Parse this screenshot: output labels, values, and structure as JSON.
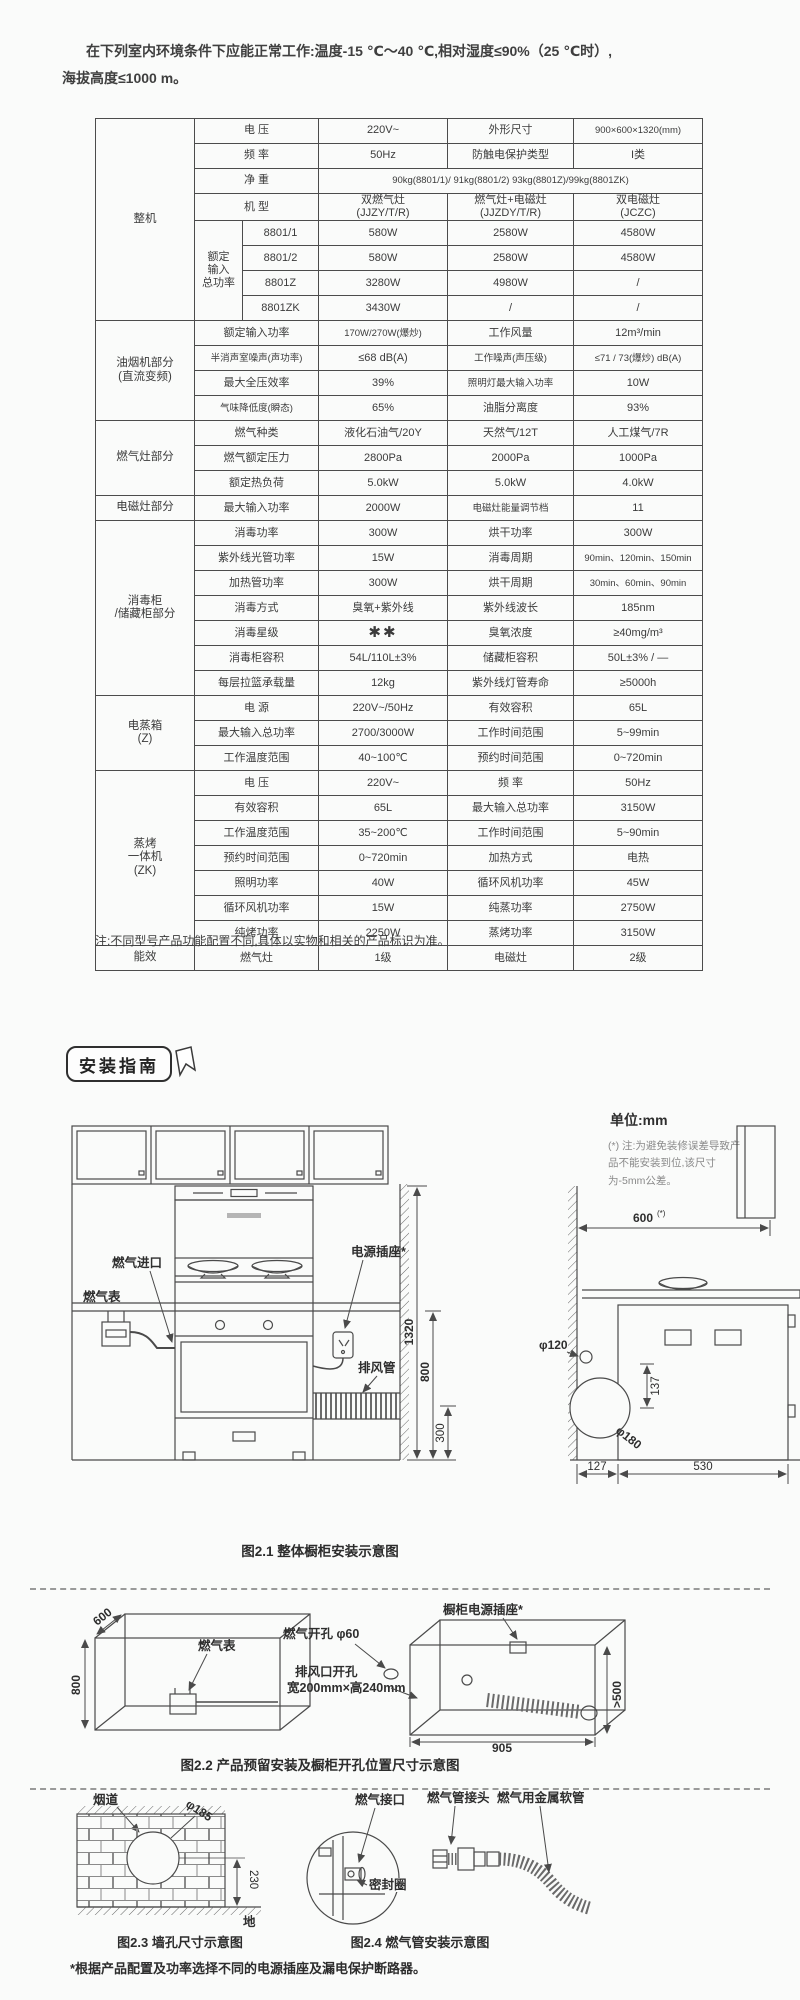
{
  "page": {
    "intro_line1": "在下列室内环境条件下应能正常工作:温度-15 ℃～40 ℃,相对湿度≤90%（25 ℃时）,",
    "intro_line2": "海拔高度≤1000 m。",
    "table_note": "注:不同型号产品功能配置不同,具体以实物和相关的产品标识为准。",
    "bottom_note": "*根据产品配置及功率选择不同的电源插座及漏电保护断路器。",
    "colors": {
      "line": "#4a4a4a",
      "text": "#3a3a3a",
      "note_gray": "#8a8a8a"
    }
  },
  "install": {
    "badge": "安装指南",
    "unit_label": "单位:mm",
    "tolerance_note": "(*) 注:为避免装修误差导致产品不能安装到位,该尺寸为-5mm公差。"
  },
  "spec_table": {
    "rows": [
      [
        {
          "t": "整机",
          "rs": 8,
          "c": "g"
        },
        {
          "t": "电  压",
          "cs": 2,
          "c": "l"
        },
        {
          "t": "220V~"
        },
        {
          "t": "外形尺寸",
          "c": "l"
        },
        {
          "t": "900×600×1320(mm)",
          "c": "xs"
        }
      ],
      [
        {
          "t": "频  率",
          "cs": 2,
          "c": "l"
        },
        {
          "t": "50Hz"
        },
        {
          "t": "防触电保护类型",
          "c": "l"
        },
        {
          "t": "I类"
        }
      ],
      [
        {
          "t": "净  重",
          "cs": 2,
          "c": "l"
        },
        {
          "t": "90kg(8801/1)/ 91kg(8801/2) 93kg(8801Z)/99kg(8801ZK)",
          "cs": 3,
          "c": "xs"
        }
      ],
      [
        {
          "t": "机  型",
          "cs": 2,
          "c": "l"
        },
        {
          "t": "双燃气灶\n(JJZY/T/R)"
        },
        {
          "t": "燃气灶+电磁灶\n(JJZDY/T/R)"
        },
        {
          "t": "双电磁灶\n(JCZC)"
        }
      ],
      [
        {
          "t": "额定\n输入\n总功率",
          "rs": 4,
          "c": "l"
        },
        {
          "t": "8801/1"
        },
        {
          "t": "580W"
        },
        {
          "t": "2580W"
        },
        {
          "t": "4580W"
        }
      ],
      [
        {
          "t": "8801/2"
        },
        {
          "t": "580W"
        },
        {
          "t": "2580W"
        },
        {
          "t": "4580W"
        }
      ],
      [
        {
          "t": "8801Z"
        },
        {
          "t": "3280W"
        },
        {
          "t": "4980W"
        },
        {
          "t": "/"
        }
      ],
      [
        {
          "t": "8801ZK"
        },
        {
          "t": "3430W"
        },
        {
          "t": "/"
        },
        {
          "t": "/"
        }
      ],
      [
        {
          "t": "油烟机部分\n(直流变频)",
          "rs": 4,
          "c": "g"
        },
        {
          "t": "额定输入功率",
          "cs": 2,
          "c": "l"
        },
        {
          "t": "170W/270W(爆炒)",
          "c": "xs"
        },
        {
          "t": "工作风量",
          "c": "l"
        },
        {
          "t": "12m³/min"
        }
      ],
      [
        {
          "t": "半消声室噪声(声功率)",
          "cs": 2,
          "c": "l xs"
        },
        {
          "t": "≤68 dB(A)"
        },
        {
          "t": "工作噪声(声压级)",
          "c": "l xs"
        },
        {
          "t": "≤71 / 73(爆炒) dB(A)",
          "c": "xs"
        }
      ],
      [
        {
          "t": "最大全压效率",
          "cs": 2,
          "c": "l"
        },
        {
          "t": "39%"
        },
        {
          "t": "照明灯最大输入功率",
          "c": "l xs"
        },
        {
          "t": "10W"
        }
      ],
      [
        {
          "t": "气味降低度(瞬态)",
          "cs": 2,
          "c": "l xs"
        },
        {
          "t": "65%"
        },
        {
          "t": "油脂分离度",
          "c": "l"
        },
        {
          "t": "93%"
        }
      ],
      [
        {
          "t": "燃气灶部分",
          "rs": 3,
          "c": "g"
        },
        {
          "t": "燃气种类",
          "cs": 2,
          "c": "l"
        },
        {
          "t": "液化石油气/20Y"
        },
        {
          "t": "天然气/12T"
        },
        {
          "t": "人工煤气/7R"
        }
      ],
      [
        {
          "t": "燃气额定压力",
          "cs": 2,
          "c": "l"
        },
        {
          "t": "2800Pa"
        },
        {
          "t": "2000Pa"
        },
        {
          "t": "1000Pa"
        }
      ],
      [
        {
          "t": "额定热负荷",
          "cs": 2,
          "c": "l"
        },
        {
          "t": "5.0kW"
        },
        {
          "t": "5.0kW"
        },
        {
          "t": "4.0kW"
        }
      ],
      [
        {
          "t": "电磁灶部分",
          "c": "g"
        },
        {
          "t": "最大输入功率",
          "cs": 2,
          "c": "l"
        },
        {
          "t": "2000W"
        },
        {
          "t": "电磁灶能量调节档",
          "c": "l xs"
        },
        {
          "t": "11"
        }
      ],
      [
        {
          "t": "消毒柜\n/储藏柜部分",
          "rs": 7,
          "c": "g"
        },
        {
          "t": "消毒功率",
          "cs": 2,
          "c": "l"
        },
        {
          "t": "300W"
        },
        {
          "t": "烘干功率",
          "c": "l"
        },
        {
          "t": "300W"
        }
      ],
      [
        {
          "t": "紫外线光管功率",
          "cs": 2,
          "c": "l"
        },
        {
          "t": "15W"
        },
        {
          "t": "消毒周期",
          "c": "l"
        },
        {
          "t": "90min、120min、150min",
          "c": "xs"
        }
      ],
      [
        {
          "t": "加热管功率",
          "cs": 2,
          "c": "l"
        },
        {
          "t": "300W"
        },
        {
          "t": "烘干周期",
          "c": "l"
        },
        {
          "t": "30min、60min、90min",
          "c": "xs"
        }
      ],
      [
        {
          "t": "消毒方式",
          "cs": 2,
          "c": "l"
        },
        {
          "t": "臭氧+紫外线"
        },
        {
          "t": "紫外线波长",
          "c": "l"
        },
        {
          "t": "185nm"
        }
      ],
      [
        {
          "t": "消毒星级",
          "cs": 2,
          "c": "l"
        },
        {
          "t": "✱✱",
          "c": "star"
        },
        {
          "t": "臭氧浓度",
          "c": "l"
        },
        {
          "t": "≥40mg/m³"
        }
      ],
      [
        {
          "t": "消毒柜容积",
          "cs": 2,
          "c": "l"
        },
        {
          "t": "54L/110L±3%"
        },
        {
          "t": "储藏柜容积",
          "c": "l"
        },
        {
          "t": "50L±3% / —"
        }
      ],
      [
        {
          "t": "每层拉篮承载量",
          "cs": 2,
          "c": "l"
        },
        {
          "t": "12kg"
        },
        {
          "t": "紫外线灯管寿命",
          "c": "l"
        },
        {
          "t": "≥5000h"
        }
      ],
      [
        {
          "t": "电蒸箱\n(Z)",
          "rs": 3,
          "c": "g"
        },
        {
          "t": "电  源",
          "cs": 2,
          "c": "l"
        },
        {
          "t": "220V~/50Hz"
        },
        {
          "t": "有效容积",
          "c": "l"
        },
        {
          "t": "65L"
        }
      ],
      [
        {
          "t": "最大输入总功率",
          "cs": 2,
          "c": "l"
        },
        {
          "t": "2700/3000W"
        },
        {
          "t": "工作时间范围",
          "c": "l"
        },
        {
          "t": "5~99min"
        }
      ],
      [
        {
          "t": "工作温度范围",
          "cs": 2,
          "c": "l"
        },
        {
          "t": "40~100℃"
        },
        {
          "t": "预约时间范围",
          "c": "l"
        },
        {
          "t": "0~720min"
        }
      ],
      [
        {
          "t": "蒸烤\n一体机\n(ZK)",
          "rs": 7,
          "c": "g"
        },
        {
          "t": "电  压",
          "cs": 2,
          "c": "l"
        },
        {
          "t": "220V~"
        },
        {
          "t": "频  率",
          "c": "l"
        },
        {
          "t": "50Hz"
        }
      ],
      [
        {
          "t": "有效容积",
          "cs": 2,
          "c": "l"
        },
        {
          "t": "65L"
        },
        {
          "t": "最大输入总功率",
          "c": "l"
        },
        {
          "t": "3150W"
        }
      ],
      [
        {
          "t": "工作温度范围",
          "cs": 2,
          "c": "l"
        },
        {
          "t": "35~200℃"
        },
        {
          "t": "工作时间范围",
          "c": "l"
        },
        {
          "t": "5~90min"
        }
      ],
      [
        {
          "t": "预约时间范围",
          "cs": 2,
          "c": "l"
        },
        {
          "t": "0~720min"
        },
        {
          "t": "加热方式",
          "c": "l"
        },
        {
          "t": "电热"
        }
      ],
      [
        {
          "t": "照明功率",
          "cs": 2,
          "c": "l"
        },
        {
          "t": "40W"
        },
        {
          "t": "循环风机功率",
          "c": "l"
        },
        {
          "t": "45W"
        }
      ],
      [
        {
          "t": "循环风机功率",
          "cs": 2,
          "c": "l"
        },
        {
          "t": "15W"
        },
        {
          "t": "纯蒸功率",
          "c": "l"
        },
        {
          "t": "2750W"
        }
      ],
      [
        {
          "t": "纯烤功率",
          "cs": 2,
          "c": "l"
        },
        {
          "t": "2250W"
        },
        {
          "t": "蒸烤功率",
          "c": "l"
        },
        {
          "t": "3150W"
        }
      ],
      [
        {
          "t": "能效",
          "c": "g"
        },
        {
          "t": "燃气灶",
          "cs": 2,
          "c": "l"
        },
        {
          "t": "1级"
        },
        {
          "t": "电磁灶",
          "c": "l"
        },
        {
          "t": "2级"
        }
      ]
    ]
  },
  "fig21": {
    "caption": "图2.1 整体橱柜安装示意图",
    "labels": {
      "gas_inlet": "燃气进口",
      "gas_meter": "燃气表",
      "power_socket": "电源插座*",
      "exhaust_duct": "排风管"
    },
    "dims": {
      "h_total": "1320",
      "h_counter": "800",
      "h_duct": "300",
      "d600": "600",
      "d600_sup": "(*)",
      "d120": "φ120",
      "d137": "137",
      "d180": "φ180",
      "d127": "127",
      "d530": "530"
    }
  },
  "fig22": {
    "caption": "图2.2 产品预留安装及橱柜开孔位置尺寸示意图",
    "labels": {
      "gas_meter": "燃气表",
      "gas_hole": "燃气开孔 φ60",
      "vent_hole1": "排风口开孔",
      "vent_hole2": "宽200mm×高240mm",
      "socket": "橱柜电源插座*"
    },
    "dims": {
      "d600": "600",
      "d800": "800",
      "d905": "905",
      "dgt500": ">500"
    }
  },
  "fig23": {
    "caption": "图2.3 墙孔尺寸示意图",
    "labels": {
      "flue": "烟道",
      "ground": "地"
    },
    "dims": {
      "d185": "φ185",
      "d230": "230"
    }
  },
  "fig24": {
    "caption": "图2.4 燃气管安装示意图",
    "labels": {
      "gas_port": "燃气接口",
      "seal": "密封圈",
      "pipe_joint": "燃气管接头",
      "metal_hose": "燃气用金属软管"
    }
  }
}
